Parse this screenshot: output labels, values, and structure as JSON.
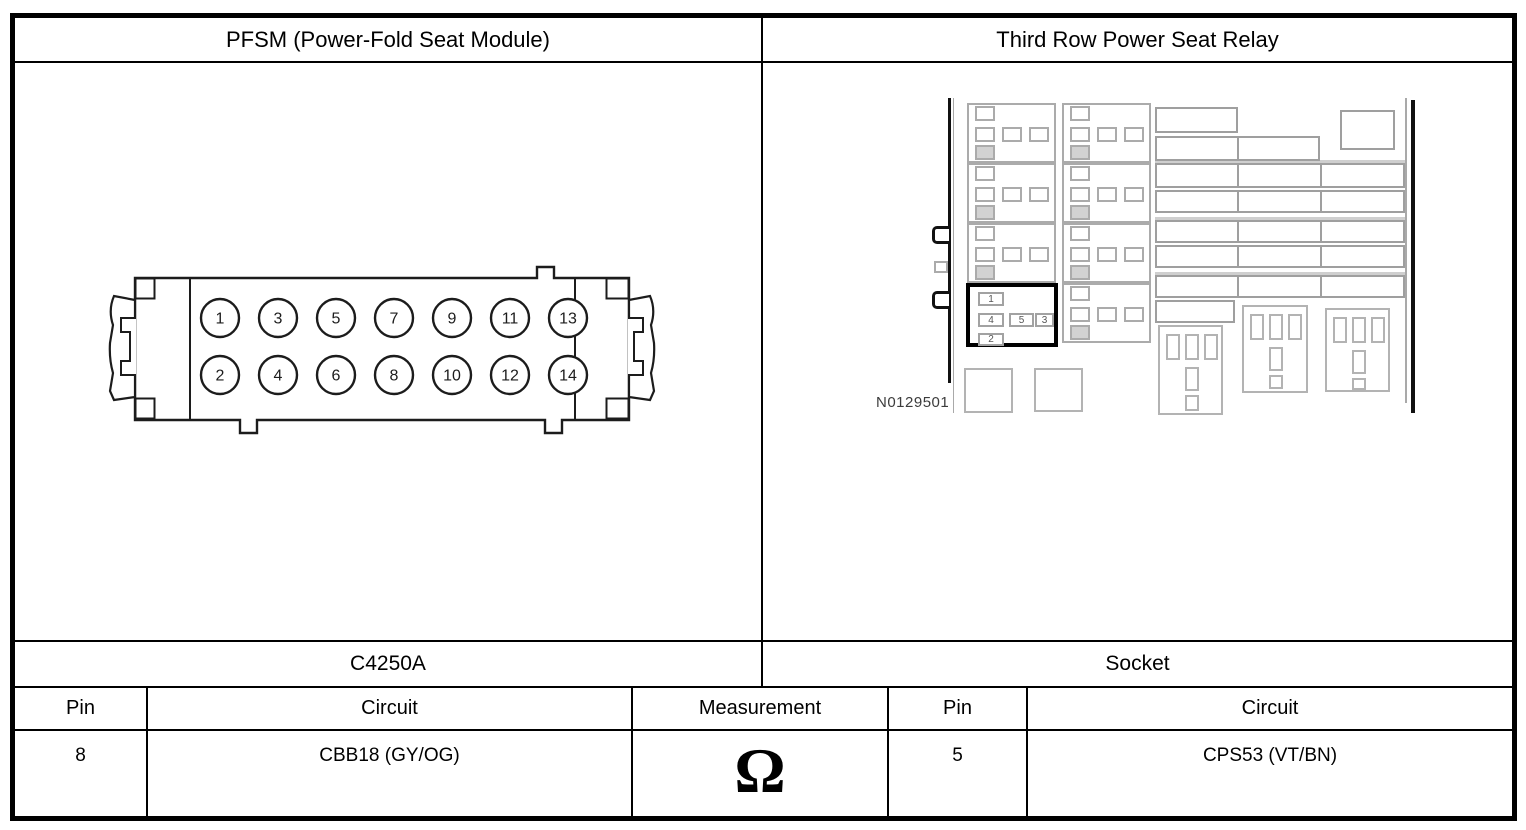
{
  "header": {
    "left_title": "PFSM (Power-Fold Seat Module)",
    "right_title": "Third Row Power Seat Relay"
  },
  "left_panel": {
    "connector_name": "C4250A",
    "connector": {
      "top_row_pins": [
        "1",
        "3",
        "5",
        "7",
        "9",
        "11",
        "13"
      ],
      "bottom_row_pins": [
        "2",
        "4",
        "6",
        "8",
        "10",
        "12",
        "14"
      ]
    }
  },
  "right_panel": {
    "connector_name": "Socket",
    "figure_ref": "N0129501",
    "socket_pins": {
      "top": "1",
      "mid_left": "4",
      "mid_center": "5",
      "mid_right": "3",
      "bottom": "2"
    }
  },
  "table": {
    "left_pin_header": "Pin",
    "left_circuit_header": "Circuit",
    "measurement_header": "Measurement",
    "right_pin_header": "Pin",
    "right_circuit_header": "Circuit",
    "row": {
      "left_pin": "8",
      "left_circuit": "CBB18 (GY/OG)",
      "measurement_symbol": "Ω",
      "right_pin": "5",
      "right_circuit": "CPS53 (VT/BN)"
    }
  },
  "colors": {
    "ink": "#000000",
    "diagram_gray": "#a9a9a9",
    "fill_gray": "#d2d2d2"
  }
}
